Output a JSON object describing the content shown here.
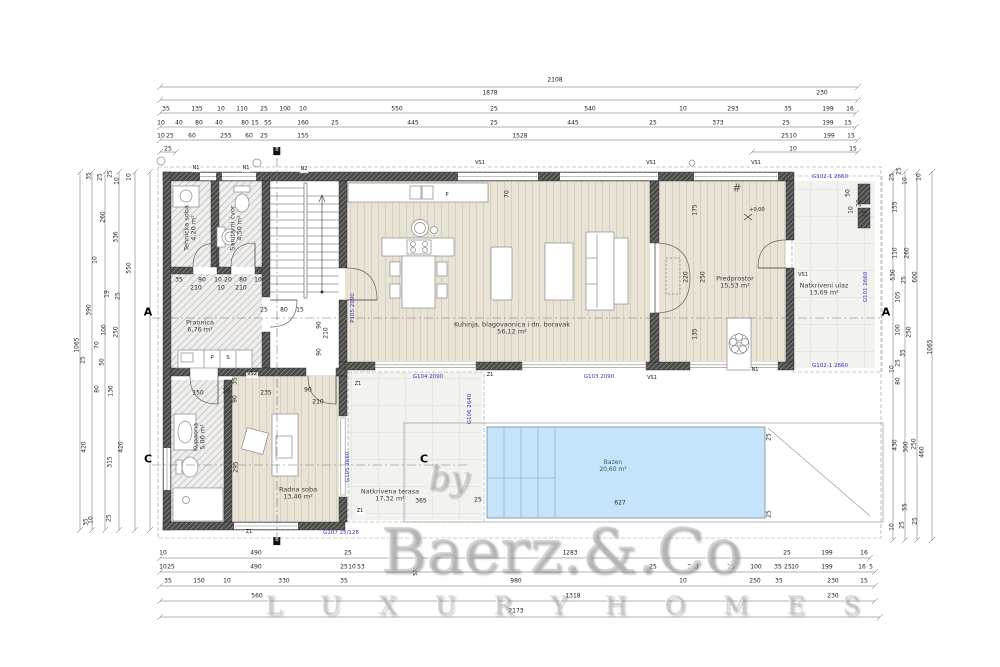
{
  "watermark": {
    "by": "by",
    "brand": "Baerz.&.Co",
    "tagline": "L U X U R Y   H O M E S"
  },
  "colors": {
    "code_blue": "#3434c0",
    "pool_fill": "#c5e4f9",
    "wall_dark": "#4a4a48",
    "wood": "#e9e3d6"
  },
  "rooms_summary": [
    {
      "name": "Tehnička soba",
      "area": "4,20 m²"
    },
    {
      "name": "Sanitarni čvor",
      "area": "4,50 m²"
    },
    {
      "name": "Praonica",
      "area": "6,76 m²"
    },
    {
      "name": "Kuhinja, blagovaonica i dn. boravak",
      "area": "56,12 m²"
    },
    {
      "name": "Predprostor",
      "area": "15,53 m²"
    },
    {
      "name": "Natkriveni ulaz",
      "area": "13,69 m²"
    },
    {
      "name": "Kupaona",
      "area": "5,06 m²"
    },
    {
      "name": "Radna soba",
      "area": "13,46 m²"
    },
    {
      "name": "Natkrivena terasa",
      "area": "17,32 m²"
    },
    {
      "name": "Bazen",
      "area": "20,60 m²"
    }
  ],
  "labels": [
    {
      "t": "2108",
      "x": 555,
      "y": 81
    },
    {
      "t": "1878",
      "x": 490,
      "y": 94
    },
    {
      "t": "230",
      "x": 822,
      "y": 94
    },
    {
      "t": "35",
      "x": 166,
      "y": 110
    },
    {
      "t": "135",
      "x": 197,
      "y": 110
    },
    {
      "t": "10",
      "x": 221,
      "y": 110
    },
    {
      "t": "110",
      "x": 242,
      "y": 110
    },
    {
      "t": "25",
      "x": 264,
      "y": 110
    },
    {
      "t": "100",
      "x": 285,
      "y": 110
    },
    {
      "t": "10",
      "x": 303,
      "y": 110
    },
    {
      "t": "550",
      "x": 397,
      "y": 110
    },
    {
      "t": "25",
      "x": 494,
      "y": 110
    },
    {
      "t": "540",
      "x": 590,
      "y": 110
    },
    {
      "t": "10",
      "x": 683,
      "y": 110
    },
    {
      "t": "293",
      "x": 733,
      "y": 110
    },
    {
      "t": "35",
      "x": 788,
      "y": 110
    },
    {
      "t": "199",
      "x": 828,
      "y": 110
    },
    {
      "t": "16",
      "x": 850,
      "y": 110
    },
    {
      "t": "10",
      "x": 161,
      "y": 124
    },
    {
      "t": "40",
      "x": 179,
      "y": 124
    },
    {
      "t": "80",
      "x": 199,
      "y": 124
    },
    {
      "t": "40",
      "x": 219,
      "y": 124
    },
    {
      "t": "80",
      "x": 245,
      "y": 124
    },
    {
      "t": "15",
      "x": 255,
      "y": 124
    },
    {
      "t": "55",
      "x": 268,
      "y": 124
    },
    {
      "t": "160",
      "x": 303,
      "y": 124
    },
    {
      "t": "25",
      "x": 335,
      "y": 124
    },
    {
      "t": "445",
      "x": 413,
      "y": 124
    },
    {
      "t": "25",
      "x": 494,
      "y": 124
    },
    {
      "t": "445",
      "x": 573,
      "y": 124
    },
    {
      "t": "25",
      "x": 653,
      "y": 124
    },
    {
      "t": "373",
      "x": 718,
      "y": 124
    },
    {
      "t": "25",
      "x": 786,
      "y": 124
    },
    {
      "t": "199",
      "x": 828,
      "y": 124
    },
    {
      "t": "15",
      "x": 848,
      "y": 124
    },
    {
      "t": "10",
      "x": 161,
      "y": 137
    },
    {
      "t": "25",
      "x": 170,
      "y": 137
    },
    {
      "t": "60",
      "x": 192,
      "y": 137
    },
    {
      "t": "255",
      "x": 226,
      "y": 137
    },
    {
      "t": "60",
      "x": 249,
      "y": 137
    },
    {
      "t": "25",
      "x": 264,
      "y": 137
    },
    {
      "t": "155",
      "x": 303,
      "y": 137
    },
    {
      "t": "1528",
      "x": 520,
      "y": 137
    },
    {
      "t": "25",
      "x": 785,
      "y": 137
    },
    {
      "t": "10",
      "x": 793,
      "y": 137
    },
    {
      "t": "199",
      "x": 829,
      "y": 137
    },
    {
      "t": "15",
      "x": 851,
      "y": 137
    },
    {
      "t": "25",
      "x": 168,
      "y": 150
    },
    {
      "t": "10",
      "x": 793,
      "y": 150
    },
    {
      "t": "15",
      "x": 853,
      "y": 150
    },
    {
      "t": "10",
      "x": 163,
      "y": 554
    },
    {
      "t": "490",
      "x": 256,
      "y": 554
    },
    {
      "t": "25",
      "x": 348,
      "y": 554
    },
    {
      "t": "1283",
      "x": 570,
      "y": 554
    },
    {
      "t": "25",
      "x": 787,
      "y": 554
    },
    {
      "t": "199",
      "x": 827,
      "y": 554
    },
    {
      "t": "16",
      "x": 864,
      "y": 554
    },
    {
      "t": "10",
      "x": 163,
      "y": 568
    },
    {
      "t": "25",
      "x": 171,
      "y": 568
    },
    {
      "t": "490",
      "x": 256,
      "y": 568
    },
    {
      "t": "25",
      "x": 344,
      "y": 568
    },
    {
      "t": "10",
      "x": 352,
      "y": 568
    },
    {
      "t": "53",
      "x": 361,
      "y": 568
    },
    {
      "t": "575",
      "x": 417,
      "y": 571,
      "r": -90,
      "s": 5
    },
    {
      "t": "25",
      "x": 653,
      "y": 568
    },
    {
      "t": "203",
      "x": 693,
      "y": 568
    },
    {
      "t": "25",
      "x": 731,
      "y": 568
    },
    {
      "t": "100",
      "x": 756,
      "y": 568
    },
    {
      "t": "35",
      "x": 778,
      "y": 568
    },
    {
      "t": "25",
      "x": 788,
      "y": 568
    },
    {
      "t": "10",
      "x": 795,
      "y": 568
    },
    {
      "t": "199",
      "x": 827,
      "y": 568
    },
    {
      "t": "16",
      "x": 862,
      "y": 568
    },
    {
      "t": "5",
      "x": 871,
      "y": 568
    },
    {
      "t": "35",
      "x": 168,
      "y": 582
    },
    {
      "t": "150",
      "x": 199,
      "y": 582
    },
    {
      "t": "10",
      "x": 227,
      "y": 582
    },
    {
      "t": "330",
      "x": 284,
      "y": 582
    },
    {
      "t": "35",
      "x": 344,
      "y": 582
    },
    {
      "t": "980",
      "x": 516,
      "y": 582
    },
    {
      "t": "10",
      "x": 683,
      "y": 582
    },
    {
      "t": "250",
      "x": 755,
      "y": 582
    },
    {
      "t": "35",
      "x": 779,
      "y": 582
    },
    {
      "t": "230",
      "x": 833,
      "y": 582
    },
    {
      "t": "15",
      "x": 864,
      "y": 582
    },
    {
      "t": "560",
      "x": 257,
      "y": 597
    },
    {
      "t": "1318",
      "x": 573,
      "y": 597
    },
    {
      "t": "230",
      "x": 833,
      "y": 597
    },
    {
      "t": "2173",
      "x": 516,
      "y": 612
    },
    {
      "t": "1065",
      "x": 78,
      "y": 345,
      "r": -90
    },
    {
      "t": "35",
      "x": 90,
      "y": 176,
      "r": -90
    },
    {
      "t": "25",
      "x": 101,
      "y": 177,
      "r": -90
    },
    {
      "t": "25",
      "x": 111,
      "y": 174,
      "r": -90
    },
    {
      "t": "10",
      "x": 118,
      "y": 181,
      "r": -90
    },
    {
      "t": "10",
      "x": 130,
      "y": 177,
      "r": -90
    },
    {
      "t": "260",
      "x": 104,
      "y": 217,
      "r": -90
    },
    {
      "t": "336",
      "x": 117,
      "y": 237,
      "r": -90
    },
    {
      "t": "550",
      "x": 130,
      "y": 268,
      "r": -90
    },
    {
      "t": "10",
      "x": 96,
      "y": 260,
      "r": -90
    },
    {
      "t": "19",
      "x": 108,
      "y": 294,
      "r": -90
    },
    {
      "t": "25",
      "x": 119,
      "y": 296,
      "r": -90
    },
    {
      "t": "390",
      "x": 90,
      "y": 310,
      "r": -90
    },
    {
      "t": "100",
      "x": 105,
      "y": 330,
      "r": -90
    },
    {
      "t": "250",
      "x": 117,
      "y": 332,
      "r": -90
    },
    {
      "t": "70",
      "x": 98,
      "y": 345,
      "r": -90
    },
    {
      "t": "50",
      "x": 103,
      "y": 362,
      "r": -90
    },
    {
      "t": "25",
      "x": 84,
      "y": 360,
      "r": -90
    },
    {
      "t": "80",
      "x": 98,
      "y": 389,
      "r": -90
    },
    {
      "t": "130",
      "x": 112,
      "y": 391,
      "r": -90
    },
    {
      "t": "420",
      "x": 85,
      "y": 447,
      "r": -90
    },
    {
      "t": "315",
      "x": 111,
      "y": 462,
      "r": -90
    },
    {
      "t": "420",
      "x": 122,
      "y": 447,
      "r": -90
    },
    {
      "t": "35",
      "x": 87,
      "y": 522,
      "r": -90
    },
    {
      "t": "10",
      "x": 92,
      "y": 520,
      "r": -90
    },
    {
      "t": "25",
      "x": 110,
      "y": 518,
      "r": -90
    },
    {
      "t": "25",
      "x": 893,
      "y": 177,
      "r": -90
    },
    {
      "t": "25",
      "x": 900,
      "y": 171,
      "r": -90
    },
    {
      "t": "10",
      "x": 906,
      "y": 181,
      "r": -90
    },
    {
      "t": "10",
      "x": 920,
      "y": 177,
      "r": -90
    },
    {
      "t": "155",
      "x": 896,
      "y": 207,
      "r": -90
    },
    {
      "t": "110",
      "x": 896,
      "y": 253,
      "r": -90
    },
    {
      "t": "260",
      "x": 908,
      "y": 253,
      "r": -90
    },
    {
      "t": "530",
      "x": 894,
      "y": 275,
      "r": -90
    },
    {
      "t": "25",
      "x": 905,
      "y": 280,
      "r": -90
    },
    {
      "t": "600",
      "x": 916,
      "y": 277,
      "r": -90
    },
    {
      "t": "105",
      "x": 899,
      "y": 297,
      "r": -90
    },
    {
      "t": "100",
      "x": 899,
      "y": 330,
      "r": -90
    },
    {
      "t": "250",
      "x": 910,
      "y": 332,
      "r": -90
    },
    {
      "t": "1065",
      "x": 931,
      "y": 347,
      "r": -90
    },
    {
      "t": "35",
      "x": 904,
      "y": 353,
      "r": -90
    },
    {
      "t": "25",
      "x": 899,
      "y": 363,
      "r": -90
    },
    {
      "t": "10",
      "x": 893,
      "y": 369,
      "r": -90
    },
    {
      "t": "80",
      "x": 899,
      "y": 381,
      "r": -90
    },
    {
      "t": "430",
      "x": 896,
      "y": 445,
      "r": -90
    },
    {
      "t": "300",
      "x": 907,
      "y": 447,
      "r": -90
    },
    {
      "t": "250",
      "x": 915,
      "y": 444,
      "r": -90
    },
    {
      "t": "460",
      "x": 923,
      "y": 452,
      "r": -90
    },
    {
      "t": "55",
      "x": 906,
      "y": 507,
      "r": -90
    },
    {
      "t": "10",
      "x": 893,
      "y": 527,
      "r": -90
    },
    {
      "t": "25",
      "x": 903,
      "y": 525,
      "r": -90
    },
    {
      "t": "25",
      "x": 916,
      "y": 521,
      "r": -90
    },
    {
      "t": "P105 2090",
      "x": 353,
      "y": 308,
      "r": -90,
      "c": "code"
    },
    {
      "t": "G104 2090",
      "x": 428,
      "y": 377,
      "c": "code"
    },
    {
      "t": "G103 2090",
      "x": 599,
      "y": 377,
      "c": "code"
    },
    {
      "t": "G102-1 2660",
      "x": 830,
      "y": 177,
      "c": "code"
    },
    {
      "t": "G102-1 2660",
      "x": 830,
      "y": 366,
      "c": "code"
    },
    {
      "t": "G101 2660",
      "x": 866,
      "y": 287,
      "r": -90,
      "c": "code"
    },
    {
      "t": "G106 2640",
      "x": 470,
      "y": 409,
      "r": -90,
      "c": "code"
    },
    {
      "t": "G105 2660",
      "x": 348,
      "y": 467,
      "r": -90,
      "c": "code"
    },
    {
      "t": "G107 25/128",
      "x": 341,
      "y": 533,
      "c": "code"
    },
    {
      "t": "N1",
      "x": 196,
      "y": 169,
      "c": "tag"
    },
    {
      "t": "N1",
      "x": 246,
      "y": 169,
      "c": "tag"
    },
    {
      "t": "N2",
      "x": 304,
      "y": 170,
      "c": "tag"
    },
    {
      "t": "N1",
      "x": 755,
      "y": 371,
      "c": "tag"
    },
    {
      "t": "VS2",
      "x": 252,
      "y": 375,
      "c": "tag"
    },
    {
      "t": "VS1",
      "x": 480,
      "y": 164,
      "c": "tag"
    },
    {
      "t": "VS1",
      "x": 651,
      "y": 164,
      "c": "tag"
    },
    {
      "t": "VS1",
      "x": 756,
      "y": 164,
      "c": "tag"
    },
    {
      "t": "VS1",
      "x": 803,
      "y": 276,
      "c": "tag"
    },
    {
      "t": "VS1",
      "x": 652,
      "y": 379,
      "c": "tag"
    },
    {
      "t": "Z1",
      "x": 358,
      "y": 385,
      "c": "tag"
    },
    {
      "t": "Z1",
      "x": 490,
      "y": 376,
      "c": "tag"
    },
    {
      "t": "Z1",
      "x": 360,
      "y": 512,
      "c": "tag"
    },
    {
      "t": "Z1",
      "x": 249,
      "y": 533,
      "c": "tag"
    },
    {
      "t": "B",
      "x": 277,
      "y": 151,
      "c": "box"
    },
    {
      "t": "B",
      "x": 277,
      "y": 541,
      "c": "box"
    },
    {
      "t": "A",
      "x": 148,
      "y": 313,
      "c": "sec"
    },
    {
      "t": "A",
      "x": 886,
      "y": 313,
      "c": "sec"
    },
    {
      "t": "C",
      "x": 148,
      "y": 460,
      "c": "sec"
    },
    {
      "t": "C",
      "x": 424,
      "y": 460,
      "c": "sec"
    },
    {
      "t": "Tehnička soba\n4,20 m²",
      "x": 191,
      "y": 228,
      "r": -90,
      "c": "room",
      "n": "room-label-tech"
    },
    {
      "t": "Sanitarni čvor\n4,50 m²",
      "x": 237,
      "y": 228,
      "r": -90,
      "c": "room",
      "n": "room-label-wc"
    },
    {
      "t": "Praonica\n6,76 m²",
      "x": 200,
      "y": 327,
      "c": "room",
      "n": "room-label-laundry"
    },
    {
      "t": "Kuhinja, blagovaonica i dn. boravak\n56,12 m²",
      "x": 512,
      "y": 329,
      "c": "room",
      "n": "room-label-living"
    },
    {
      "t": "Predprostor\n15,53 m²",
      "x": 735,
      "y": 283,
      "c": "room",
      "n": "room-label-hall"
    },
    {
      "t": "Natkriveni ulaz\n13,69 m²",
      "x": 824,
      "y": 290,
      "c": "room",
      "n": "room-label-entrance"
    },
    {
      "t": "Kupaona\n5,06 m²",
      "x": 200,
      "y": 437,
      "r": -90,
      "c": "room",
      "n": "room-label-bathroom"
    },
    {
      "t": "Radna soba\n13,46 m²",
      "x": 298,
      "y": 494,
      "c": "room",
      "n": "room-label-study"
    },
    {
      "t": "Natkrivena terasa\n17,32 m²",
      "x": 390,
      "y": 496,
      "c": "room",
      "n": "room-label-terrace"
    },
    {
      "t": "Bazen\n20,60 m²",
      "x": 613,
      "y": 467,
      "c": "pool",
      "n": "room-label-pool"
    },
    {
      "t": "+0,00",
      "x": 757,
      "y": 211,
      "s": 5
    },
    {
      "t": "70",
      "x": 508,
      "y": 194,
      "r": -90
    },
    {
      "t": "175",
      "x": 696,
      "y": 210,
      "r": -90
    },
    {
      "t": "220",
      "x": 687,
      "y": 277,
      "r": -90
    },
    {
      "t": "250",
      "x": 704,
      "y": 277,
      "r": -90
    },
    {
      "t": "135",
      "x": 696,
      "y": 334,
      "r": -90
    },
    {
      "t": "35",
      "x": 179,
      "y": 281
    },
    {
      "t": "90",
      "x": 202,
      "y": 281
    },
    {
      "t": "10",
      "x": 218,
      "y": 281
    },
    {
      "t": "20",
      "x": 228,
      "y": 281
    },
    {
      "t": "80",
      "x": 243,
      "y": 281
    },
    {
      "t": "10",
      "x": 258,
      "y": 281
    },
    {
      "t": "210",
      "x": 196,
      "y": 289
    },
    {
      "t": "10",
      "x": 221,
      "y": 289
    },
    {
      "t": "210",
      "x": 241,
      "y": 289
    },
    {
      "t": "25",
      "x": 264,
      "y": 311
    },
    {
      "t": "80",
      "x": 284,
      "y": 311
    },
    {
      "t": "15",
      "x": 300,
      "y": 311
    },
    {
      "t": "90",
      "x": 320,
      "y": 325,
      "r": -90
    },
    {
      "t": "210",
      "x": 327,
      "y": 333,
      "r": -90
    },
    {
      "t": "90",
      "x": 320,
      "y": 352,
      "r": -90
    },
    {
      "t": "150",
      "x": 198,
      "y": 394
    },
    {
      "t": "10",
      "x": 226,
      "y": 392
    },
    {
      "t": "235",
      "x": 266,
      "y": 394
    },
    {
      "t": "90",
      "x": 308,
      "y": 391
    },
    {
      "t": "210",
      "x": 318,
      "y": 403
    },
    {
      "t": "35",
      "x": 236,
      "y": 381,
      "r": -90
    },
    {
      "t": "90",
      "x": 236,
      "y": 399,
      "r": -90
    },
    {
      "t": "295",
      "x": 237,
      "y": 467,
      "r": -90
    },
    {
      "t": "365",
      "x": 421,
      "y": 502
    },
    {
      "t": "25",
      "x": 478,
      "y": 501
    },
    {
      "t": "627",
      "x": 620,
      "y": 504
    },
    {
      "t": "25",
      "x": 770,
      "y": 437,
      "r": -90
    },
    {
      "t": "25",
      "x": 770,
      "y": 514,
      "r": -90
    },
    {
      "t": "50",
      "x": 849,
      "y": 193,
      "r": -90
    },
    {
      "t": "20",
      "x": 860,
      "y": 203,
      "r": -90
    },
    {
      "t": "10",
      "x": 852,
      "y": 210,
      "r": -90
    },
    {
      "t": "16",
      "x": 866,
      "y": 214,
      "r": -90
    },
    {
      "t": "P",
      "x": 447,
      "y": 196,
      "s": 5
    },
    {
      "t": "P",
      "x": 212,
      "y": 358,
      "s": 5.5
    },
    {
      "t": "S",
      "x": 228,
      "y": 358,
      "s": 5.5
    },
    {
      "t": "#",
      "x": 737,
      "y": 189,
      "s": 11,
      "c": "sym"
    }
  ],
  "dim_lines": [
    {
      "o": "h",
      "a": 87,
      "b1": 160,
      "b2": 858
    },
    {
      "o": "h",
      "a": 100,
      "b1": 160,
      "b2": 858
    },
    {
      "o": "h",
      "a": 113,
      "b1": 160,
      "b2": 856
    },
    {
      "o": "h",
      "a": 127,
      "b1": 160,
      "b2": 856
    },
    {
      "o": "h",
      "a": 140,
      "b1": 160,
      "b2": 858
    },
    {
      "o": "h",
      "a": 152,
      "b1": 160,
      "b2": 176
    },
    {
      "o": "h",
      "a": 152,
      "b1": 752,
      "b2": 858
    },
    {
      "o": "h",
      "a": 558,
      "b1": 160,
      "b2": 870
    },
    {
      "o": "h",
      "a": 572,
      "b1": 160,
      "b2": 875
    },
    {
      "o": "h",
      "a": 586,
      "b1": 160,
      "b2": 875
    },
    {
      "o": "h",
      "a": 601,
      "b1": 160,
      "b2": 875
    },
    {
      "o": "h",
      "a": 617,
      "b1": 160,
      "b2": 880
    },
    {
      "o": "v",
      "a": 80,
      "b1": 172,
      "b2": 530
    },
    {
      "o": "v",
      "a": 92,
      "b1": 172,
      "b2": 530
    },
    {
      "o": "v",
      "a": 105,
      "b1": 172,
      "b2": 530
    },
    {
      "o": "v",
      "a": 119,
      "b1": 172,
      "b2": 530
    },
    {
      "o": "v",
      "a": 135,
      "b1": 172,
      "b2": 530
    },
    {
      "o": "v",
      "a": 150,
      "b1": 172,
      "b2": 530
    },
    {
      "o": "v",
      "a": 893,
      "b1": 172,
      "b2": 540
    },
    {
      "o": "v",
      "a": 905,
      "b1": 172,
      "b2": 540
    },
    {
      "o": "v",
      "a": 917,
      "b1": 172,
      "b2": 540
    },
    {
      "o": "v",
      "a": 932,
      "b1": 172,
      "b2": 540
    }
  ]
}
